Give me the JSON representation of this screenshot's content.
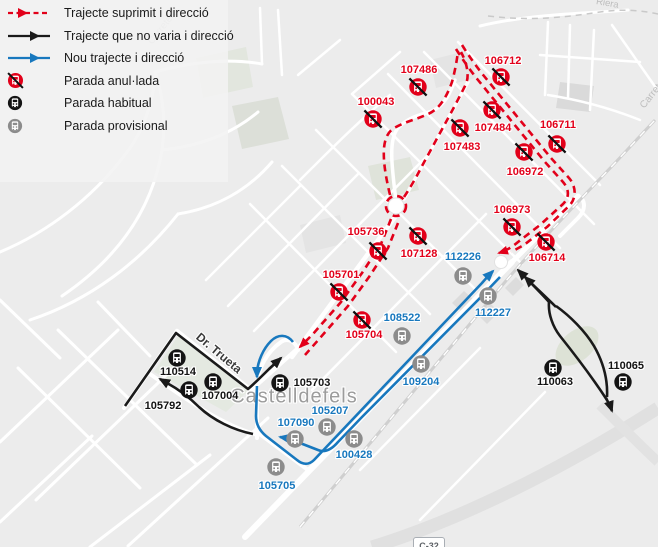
{
  "colors": {
    "suppressed": "#e2001a",
    "new": "#1878be",
    "unchanged": "#1a1a1a",
    "provisional": "#8c8c8c"
  },
  "legend": {
    "items": [
      {
        "id": "route-suppressed",
        "label": "Trajecte suprimit i direcció"
      },
      {
        "id": "route-unchanged",
        "label": "Trajecte que no varia i direcció"
      },
      {
        "id": "route-new",
        "label": "Nou trajecte i direcció"
      },
      {
        "id": "stop-cancelled",
        "label": "Parada anul·lada"
      },
      {
        "id": "stop-regular",
        "label": "Parada habitual"
      },
      {
        "id": "stop-provisional",
        "label": "Parada provisional"
      }
    ]
  },
  "map_labels": {
    "city": "Castelldefels",
    "street": "Dr. Trueta",
    "road_badge": "C-32",
    "road_top": "Riera",
    "road_right": "Carretera",
    "road_top_left": "Carretera"
  },
  "stops": [
    {
      "id": "107486",
      "type": "cancelled",
      "x": 418,
      "y": 87,
      "lx": 419,
      "ly": 70
    },
    {
      "id": "106712",
      "type": "cancelled",
      "x": 501,
      "y": 77,
      "lx": 503,
      "ly": 61
    },
    {
      "id": "100043",
      "type": "cancelled",
      "x": 373,
      "y": 119,
      "lx": 376,
      "ly": 102
    },
    {
      "id": "107484",
      "type": "cancelled",
      "x": 492,
      "y": 110,
      "lx": 493,
      "ly": 128
    },
    {
      "id": "107483",
      "type": "cancelled",
      "x": 460,
      "y": 128,
      "lx": 462,
      "ly": 147
    },
    {
      "id": "106711",
      "type": "cancelled",
      "x": 557,
      "y": 144,
      "lx": 558,
      "ly": 125
    },
    {
      "id": "106972",
      "type": "cancelled",
      "x": 524,
      "y": 152,
      "lx": 525,
      "ly": 172
    },
    {
      "id": "106973",
      "type": "cancelled",
      "x": 512,
      "y": 227,
      "lx": 512,
      "ly": 210
    },
    {
      "id": "106714",
      "type": "cancelled",
      "x": 546,
      "y": 242,
      "lx": 547,
      "ly": 258
    },
    {
      "id": "105736",
      "type": "cancelled",
      "x": 378,
      "y": 251,
      "lx": 366,
      "ly": 232
    },
    {
      "id": "107128",
      "type": "cancelled",
      "x": 418,
      "y": 236,
      "lx": 419,
      "ly": 254
    },
    {
      "id": "105701",
      "type": "cancelled",
      "x": 339,
      "y": 292,
      "lx": 341,
      "ly": 275
    },
    {
      "id": "105704",
      "type": "cancelled",
      "x": 362,
      "y": 320,
      "lx": 364,
      "ly": 335
    },
    {
      "id": "110514",
      "type": "regular",
      "x": 177,
      "y": 358,
      "lx": 178,
      "ly": 372
    },
    {
      "id": "105792",
      "type": "regular",
      "x": 189,
      "y": 390,
      "lx": 163,
      "ly": 406
    },
    {
      "id": "107004",
      "type": "regular",
      "x": 213,
      "y": 382,
      "lx": 220,
      "ly": 396
    },
    {
      "id": "105703",
      "type": "regular",
      "x": 280,
      "y": 383,
      "lx": 312,
      "ly": 383
    },
    {
      "id": "110063",
      "type": "regular",
      "x": 553,
      "y": 368,
      "lx": 555,
      "ly": 382
    },
    {
      "id": "110065",
      "type": "regular",
      "x": 623,
      "y": 382,
      "lx": 626,
      "ly": 366
    },
    {
      "id": "112226",
      "type": "provisional",
      "x": 463,
      "y": 276,
      "lx": 463,
      "ly": 257
    },
    {
      "id": "112227",
      "type": "provisional",
      "x": 488,
      "y": 296,
      "lx": 493,
      "ly": 313
    },
    {
      "id": "108522",
      "type": "provisional",
      "x": 402,
      "y": 336,
      "lx": 402,
      "ly": 318
    },
    {
      "id": "109204",
      "type": "provisional",
      "x": 421,
      "y": 364,
      "lx": 421,
      "ly": 382
    },
    {
      "id": "105207",
      "type": "provisional",
      "x": 327,
      "y": 427,
      "lx": 330,
      "ly": 411
    },
    {
      "id": "107090",
      "type": "provisional",
      "x": 295,
      "y": 439,
      "lx": 296,
      "ly": 423
    },
    {
      "id": "100428",
      "type": "provisional",
      "x": 354,
      "y": 439,
      "lx": 354,
      "ly": 455
    },
    {
      "id": "105705",
      "type": "provisional",
      "x": 276,
      "y": 467,
      "lx": 277,
      "ly": 486
    }
  ]
}
